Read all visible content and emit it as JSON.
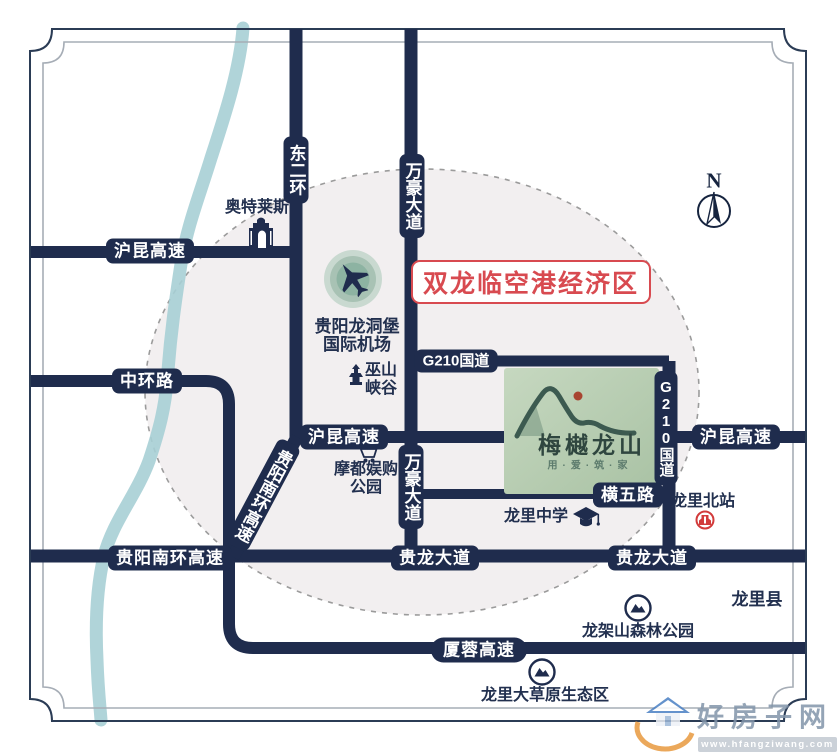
{
  "map": {
    "region_label": "双龙临空港经济区",
    "compass_n": "N",
    "roads": {
      "hukun_top": "沪昆高速",
      "zhonghuan": "中环路",
      "dongerhuan": "东二环",
      "wanhao_top": "万豪大道",
      "wanhao_mid": "万豪大道",
      "g210_horizontal": "G210国道",
      "g210_vertical": "G210国道",
      "hukun_mid": "沪昆高速",
      "hukun_right": "沪昆高速",
      "hengwu": "横五路",
      "nanhuan_diагonal": "贵阳南环高速",
      "nanhuan_diagonal": "贵阳南环高速",
      "nanhuan_horizontal": "贵阳南环高速",
      "guilong_left": "贵龙大道",
      "guilong_right": "贵龙大道",
      "xiarong": "厦蓉高速"
    },
    "landmarks": {
      "outlets": "奥特莱斯",
      "airport_line1": "贵阳龙洞堡",
      "airport_line2": "国际机场",
      "wushan_line1": "巫山",
      "wushan_line2": "峡谷",
      "modu_line1": "摩都娱购",
      "modu_line2": "公园",
      "school": "龙里中学",
      "station": "龙里北站",
      "county": "龙里县",
      "forest_park": "龙架山森林公园",
      "grassland": "龙里大草原生态区"
    },
    "project": {
      "name": "梅樾龙山",
      "slogan": "用·爱·筑·家"
    }
  },
  "watermark": {
    "site_name": "好房子网",
    "site_url": "www.hfangziwang.com"
  },
  "colors": {
    "road_navy": "#1f2c4d",
    "river_teal": "#a7cfd5",
    "region_red": "#d84a50",
    "logo_green": "#b7cdb2",
    "zone_fill": "#f2eff0"
  }
}
